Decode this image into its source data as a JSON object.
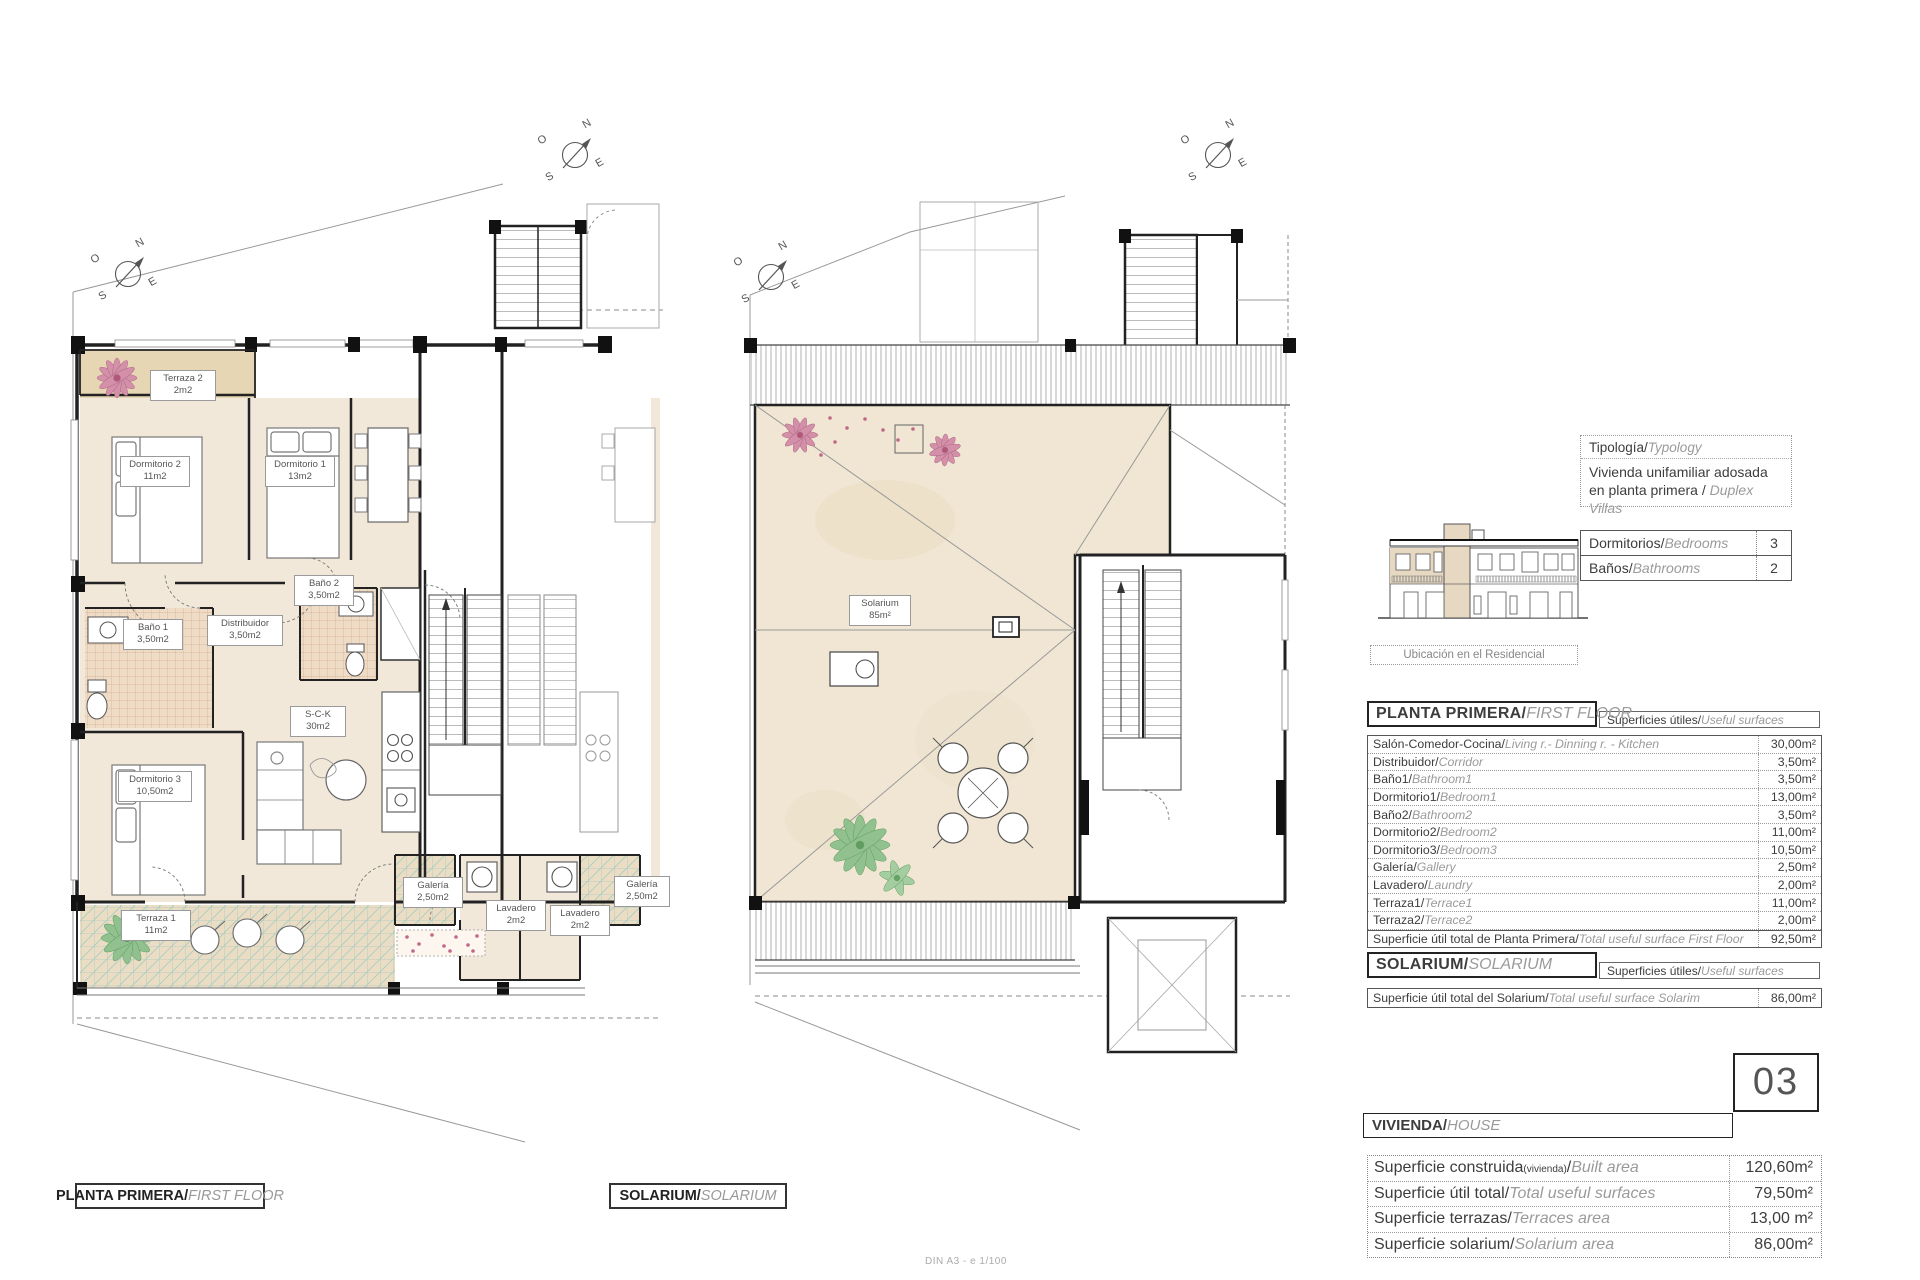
{
  "compass": {
    "n": "N",
    "o": "O",
    "e": "E",
    "s": "S"
  },
  "plans": {
    "left": {
      "caption_es": "PLANTA PRIMERA/",
      "caption_en": "FIRST FLOOR",
      "rooms": [
        {
          "id": "terraza2",
          "name": "Terraza 2",
          "area": "2m2"
        },
        {
          "id": "dormitorio2",
          "name": "Dormitorio 2",
          "area": "11m2"
        },
        {
          "id": "dormitorio1",
          "name": "Dormitorio 1",
          "area": "13m2"
        },
        {
          "id": "bano1",
          "name": "Baño 1",
          "area": "3,50m2"
        },
        {
          "id": "distribuidor",
          "name": "Distribuidor",
          "area": "3,50m2"
        },
        {
          "id": "bano2",
          "name": "Baño 2",
          "area": "3,50m2"
        },
        {
          "id": "dormitorio3",
          "name": "Dormitorio 3",
          "area": "10,50m2"
        },
        {
          "id": "sck",
          "name": "S-C-K",
          "area": "30m2"
        },
        {
          "id": "terraza1",
          "name": "Terraza 1",
          "area": "11m2"
        },
        {
          "id": "galeria",
          "name": "Galería",
          "area": "2,50m2"
        },
        {
          "id": "lavadero",
          "name": "Lavadero",
          "area": "2m2"
        },
        {
          "id": "lavadero_2",
          "name": "Lavadero",
          "area": "2m2"
        },
        {
          "id": "galeria_2",
          "name": "Galería",
          "area": "2,50m2"
        }
      ]
    },
    "middle": {
      "caption_es": "SOLARIUM/",
      "caption_en": "SOLARIUM",
      "rooms": [
        {
          "id": "solarium",
          "name": "Solarium",
          "area": "85m²"
        }
      ]
    }
  },
  "panel": {
    "typology": {
      "label_es": "Tipología/",
      "label_en": "Typology",
      "value_es": "Vivienda unifamiliar adosada en planta primera / ",
      "value_en": "Duplex Villas"
    },
    "elevation_caption": "Ubicación en el Residencial",
    "specs": [
      {
        "es": "Dormitorios/",
        "en": "Bedrooms",
        "value": "3"
      },
      {
        "es": "Baños/",
        "en": "Bathrooms",
        "value": "2"
      }
    ],
    "first_floor": {
      "header_es": "PLANTA PRIMERA/",
      "header_en": "FIRST FLOOR",
      "surfaces_es": "Superficies útiles/",
      "surfaces_en": "Useful surfaces",
      "rows": [
        {
          "es": "Salón-Comedor-Cocina/",
          "en": "Living r.- Dinning r. - Kitchen",
          "value": "30,00m²"
        },
        {
          "es": "Distribuidor/",
          "en": "Corridor",
          "value": "3,50m²"
        },
        {
          "es": "Baño1/",
          "en": "Bathroom1",
          "value": "3,50m²"
        },
        {
          "es": "Dormitorio1/",
          "en": "Bedroom1",
          "value": "13,00m²"
        },
        {
          "es": "Baño2/",
          "en": "Bathroom2",
          "value": "3,50m²"
        },
        {
          "es": "Dormitorio2/",
          "en": "Bedroom2",
          "value": "11,00m²"
        },
        {
          "es": "Dormitorio3/",
          "en": "Bedroom3",
          "value": "10,50m²"
        },
        {
          "es": "Galería/",
          "en": "Gallery",
          "value": "2,50m²"
        },
        {
          "es": "Lavadero/",
          "en": "Laundry",
          "value": "2,00m²"
        },
        {
          "es": "Terraza1/",
          "en": "Terrace1",
          "value": "11,00m²"
        },
        {
          "es": "Terraza2/",
          "en": "Terrace2",
          "value": "2,00m²"
        }
      ],
      "total": {
        "es": "Superficie útil total de Planta Primera/",
        "en": "Total useful surface First Floor",
        "value": "92,50m²"
      }
    },
    "solarium": {
      "header_es": "SOLARIUM/",
      "header_en": "SOLARIUM",
      "surfaces_es": "Superficies útiles/",
      "surfaces_en": "Useful surfaces",
      "total": {
        "es": "Superficie útil total del Solarium/",
        "en": "Total useful surface Solarim",
        "value": "86,00m²"
      }
    },
    "unit_number": "03",
    "vivienda": {
      "header_es": "VIVIENDA/",
      "header_en": "HOUSE",
      "rows": [
        {
          "es": "Superficie construida",
          "sub": "(vivienda)",
          "sep": "/",
          "en": "Built area",
          "value": "120,60m²"
        },
        {
          "es": "Superficie útil total/",
          "sub": "",
          "sep": "",
          "en": "Total useful surfaces",
          "value": "79,50m²"
        },
        {
          "es": "Superficie terrazas/",
          "sub": "",
          "sep": "",
          "en": "Terraces area",
          "value": "13,00 m²"
        },
        {
          "es": "Superficie solarium/",
          "sub": "",
          "sep": "",
          "en": "Solarium area",
          "value": "86,00m²"
        }
      ]
    }
  },
  "footer_note": "DIN A3 - e 1/100"
}
